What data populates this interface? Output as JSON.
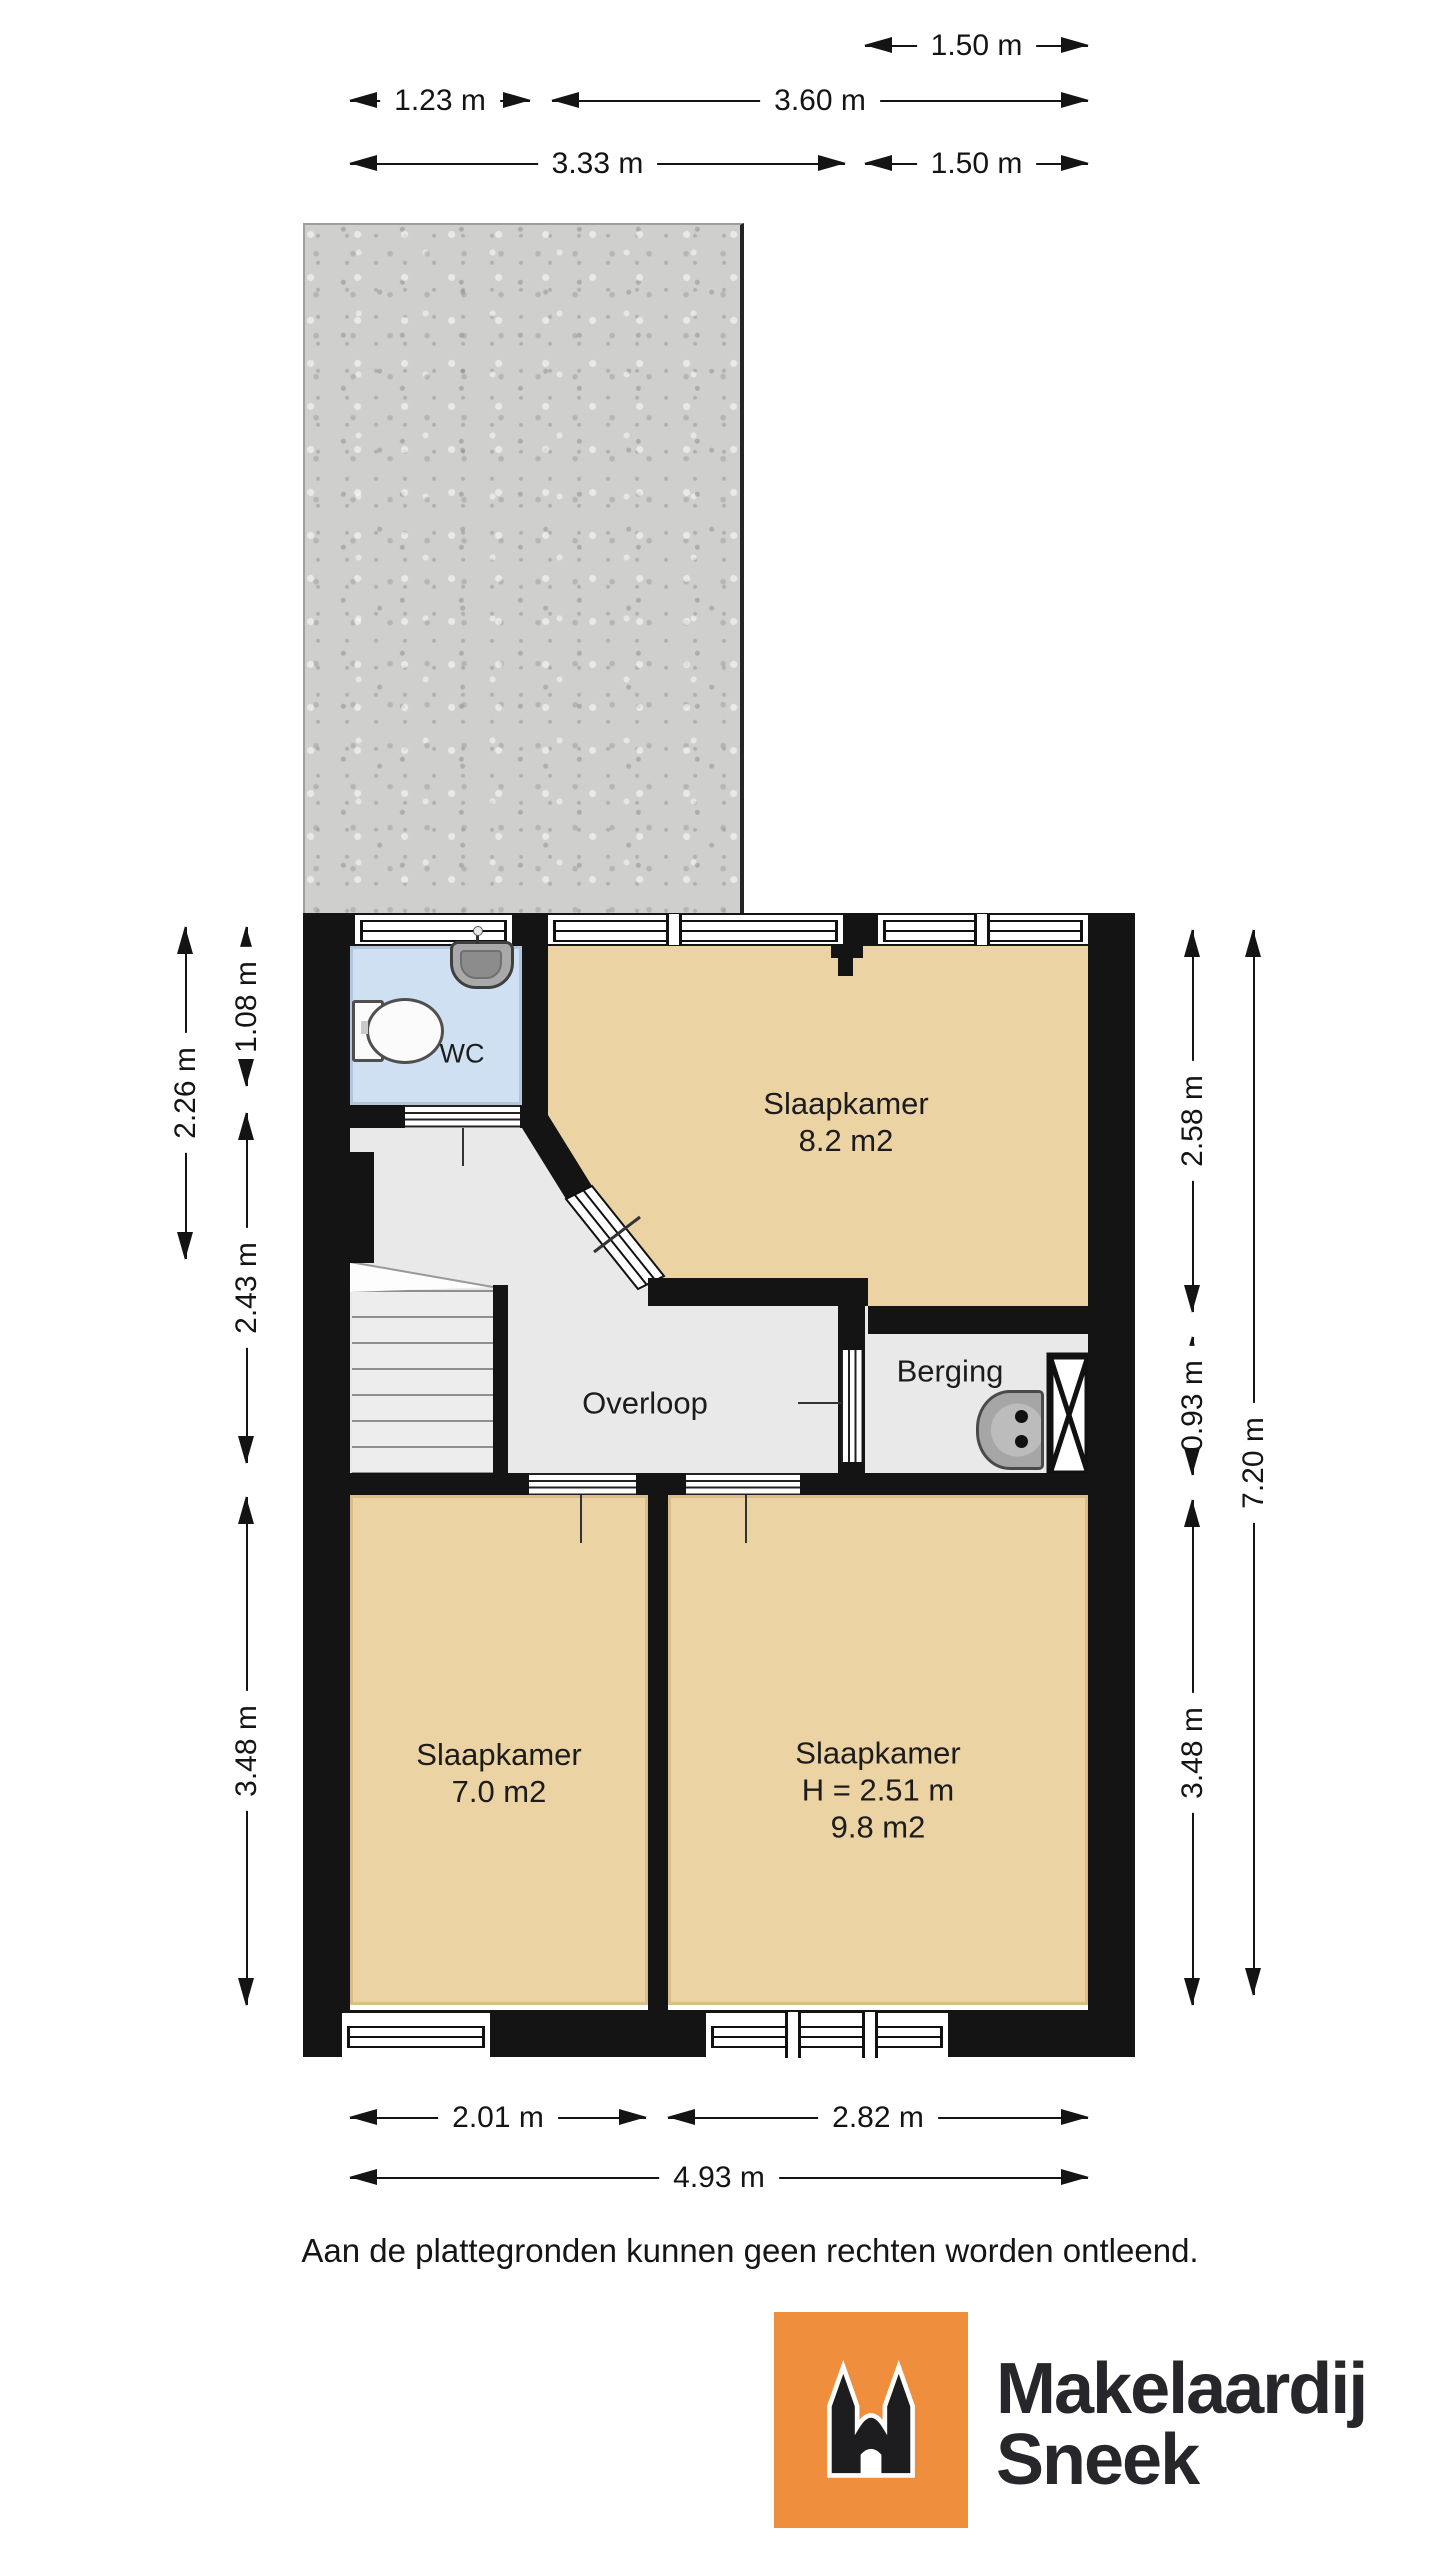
{
  "floorplan": {
    "rooms": [
      {
        "id": "wc",
        "name": "WC"
      },
      {
        "id": "slaapkamer-top",
        "name": "Slaapkamer",
        "area": "8.2 m2"
      },
      {
        "id": "overloop",
        "name": "Overloop"
      },
      {
        "id": "berging",
        "name": "Berging"
      },
      {
        "id": "slaapkamer-left",
        "name": "Slaapkamer",
        "area": "7.0 m2"
      },
      {
        "id": "slaapkamer-right",
        "name": "Slaapkamer",
        "ceiling_height": "H = 2.51 m",
        "area": "9.8 m2"
      }
    ],
    "dimensions": {
      "top": [
        {
          "label": "1.50 m"
        },
        {
          "label": "1.23 m"
        },
        {
          "label": "3.60 m"
        },
        {
          "label": "3.33 m"
        },
        {
          "label": "1.50 m"
        }
      ],
      "left": [
        {
          "label": "2.26 m"
        },
        {
          "label": "1.08 m"
        },
        {
          "label": "2.43 m"
        },
        {
          "label": "3.48 m"
        }
      ],
      "right": [
        {
          "label": "2.58 m"
        },
        {
          "label": "0.93 m"
        },
        {
          "label": "3.48 m"
        },
        {
          "label": "7.20 m"
        }
      ],
      "bottom": [
        {
          "label": "2.01 m"
        },
        {
          "label": "2.82 m"
        },
        {
          "label": "4.93 m"
        }
      ]
    }
  },
  "disclaimer": "Aan de plattegronden kunnen geen rechten worden ontleend.",
  "logo": {
    "name_line1": "Makelaardij",
    "name_line2": "Sneek"
  },
  "colors": {
    "wall": "#141414",
    "bedroom_floor": "#ecd3a4",
    "wc_floor": "#cfe0f2",
    "hall_floor": "#e9e9e9",
    "roof_terrace": "#cfcfcd",
    "logo_orange": "#ef8e3c",
    "logo_text": "#27272b"
  }
}
